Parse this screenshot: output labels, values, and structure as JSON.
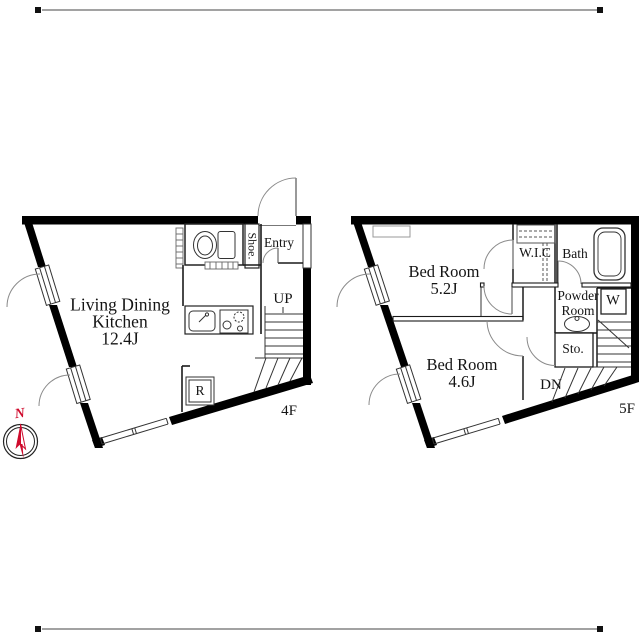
{
  "compass": {
    "north_label": "N"
  },
  "floor_4f": {
    "floor_label": "4F",
    "ldk_line1": "Living Dining",
    "ldk_line2": "Kitchen",
    "ldk_size": "12.4J",
    "shoe_label": "Shoe.",
    "entry_label": "Entry",
    "stairs_label": "UP",
    "fridge_label": "R"
  },
  "floor_5f": {
    "floor_label": "5F",
    "bedroom1_name": "Bed Room",
    "bedroom1_size": "5.2J",
    "bedroom2_name": "Bed Room",
    "bedroom2_size": "4.6J",
    "wic_label": "W.I.C",
    "bath_label": "Bath",
    "powder_line1": "Powder",
    "powder_line2": "Room",
    "washer_label": "W",
    "storage_label": "Sto.",
    "stairs_label": "DN"
  },
  "colors": {
    "wall": "#000000",
    "north_red": "#cf0a2c",
    "line": "#333333"
  }
}
